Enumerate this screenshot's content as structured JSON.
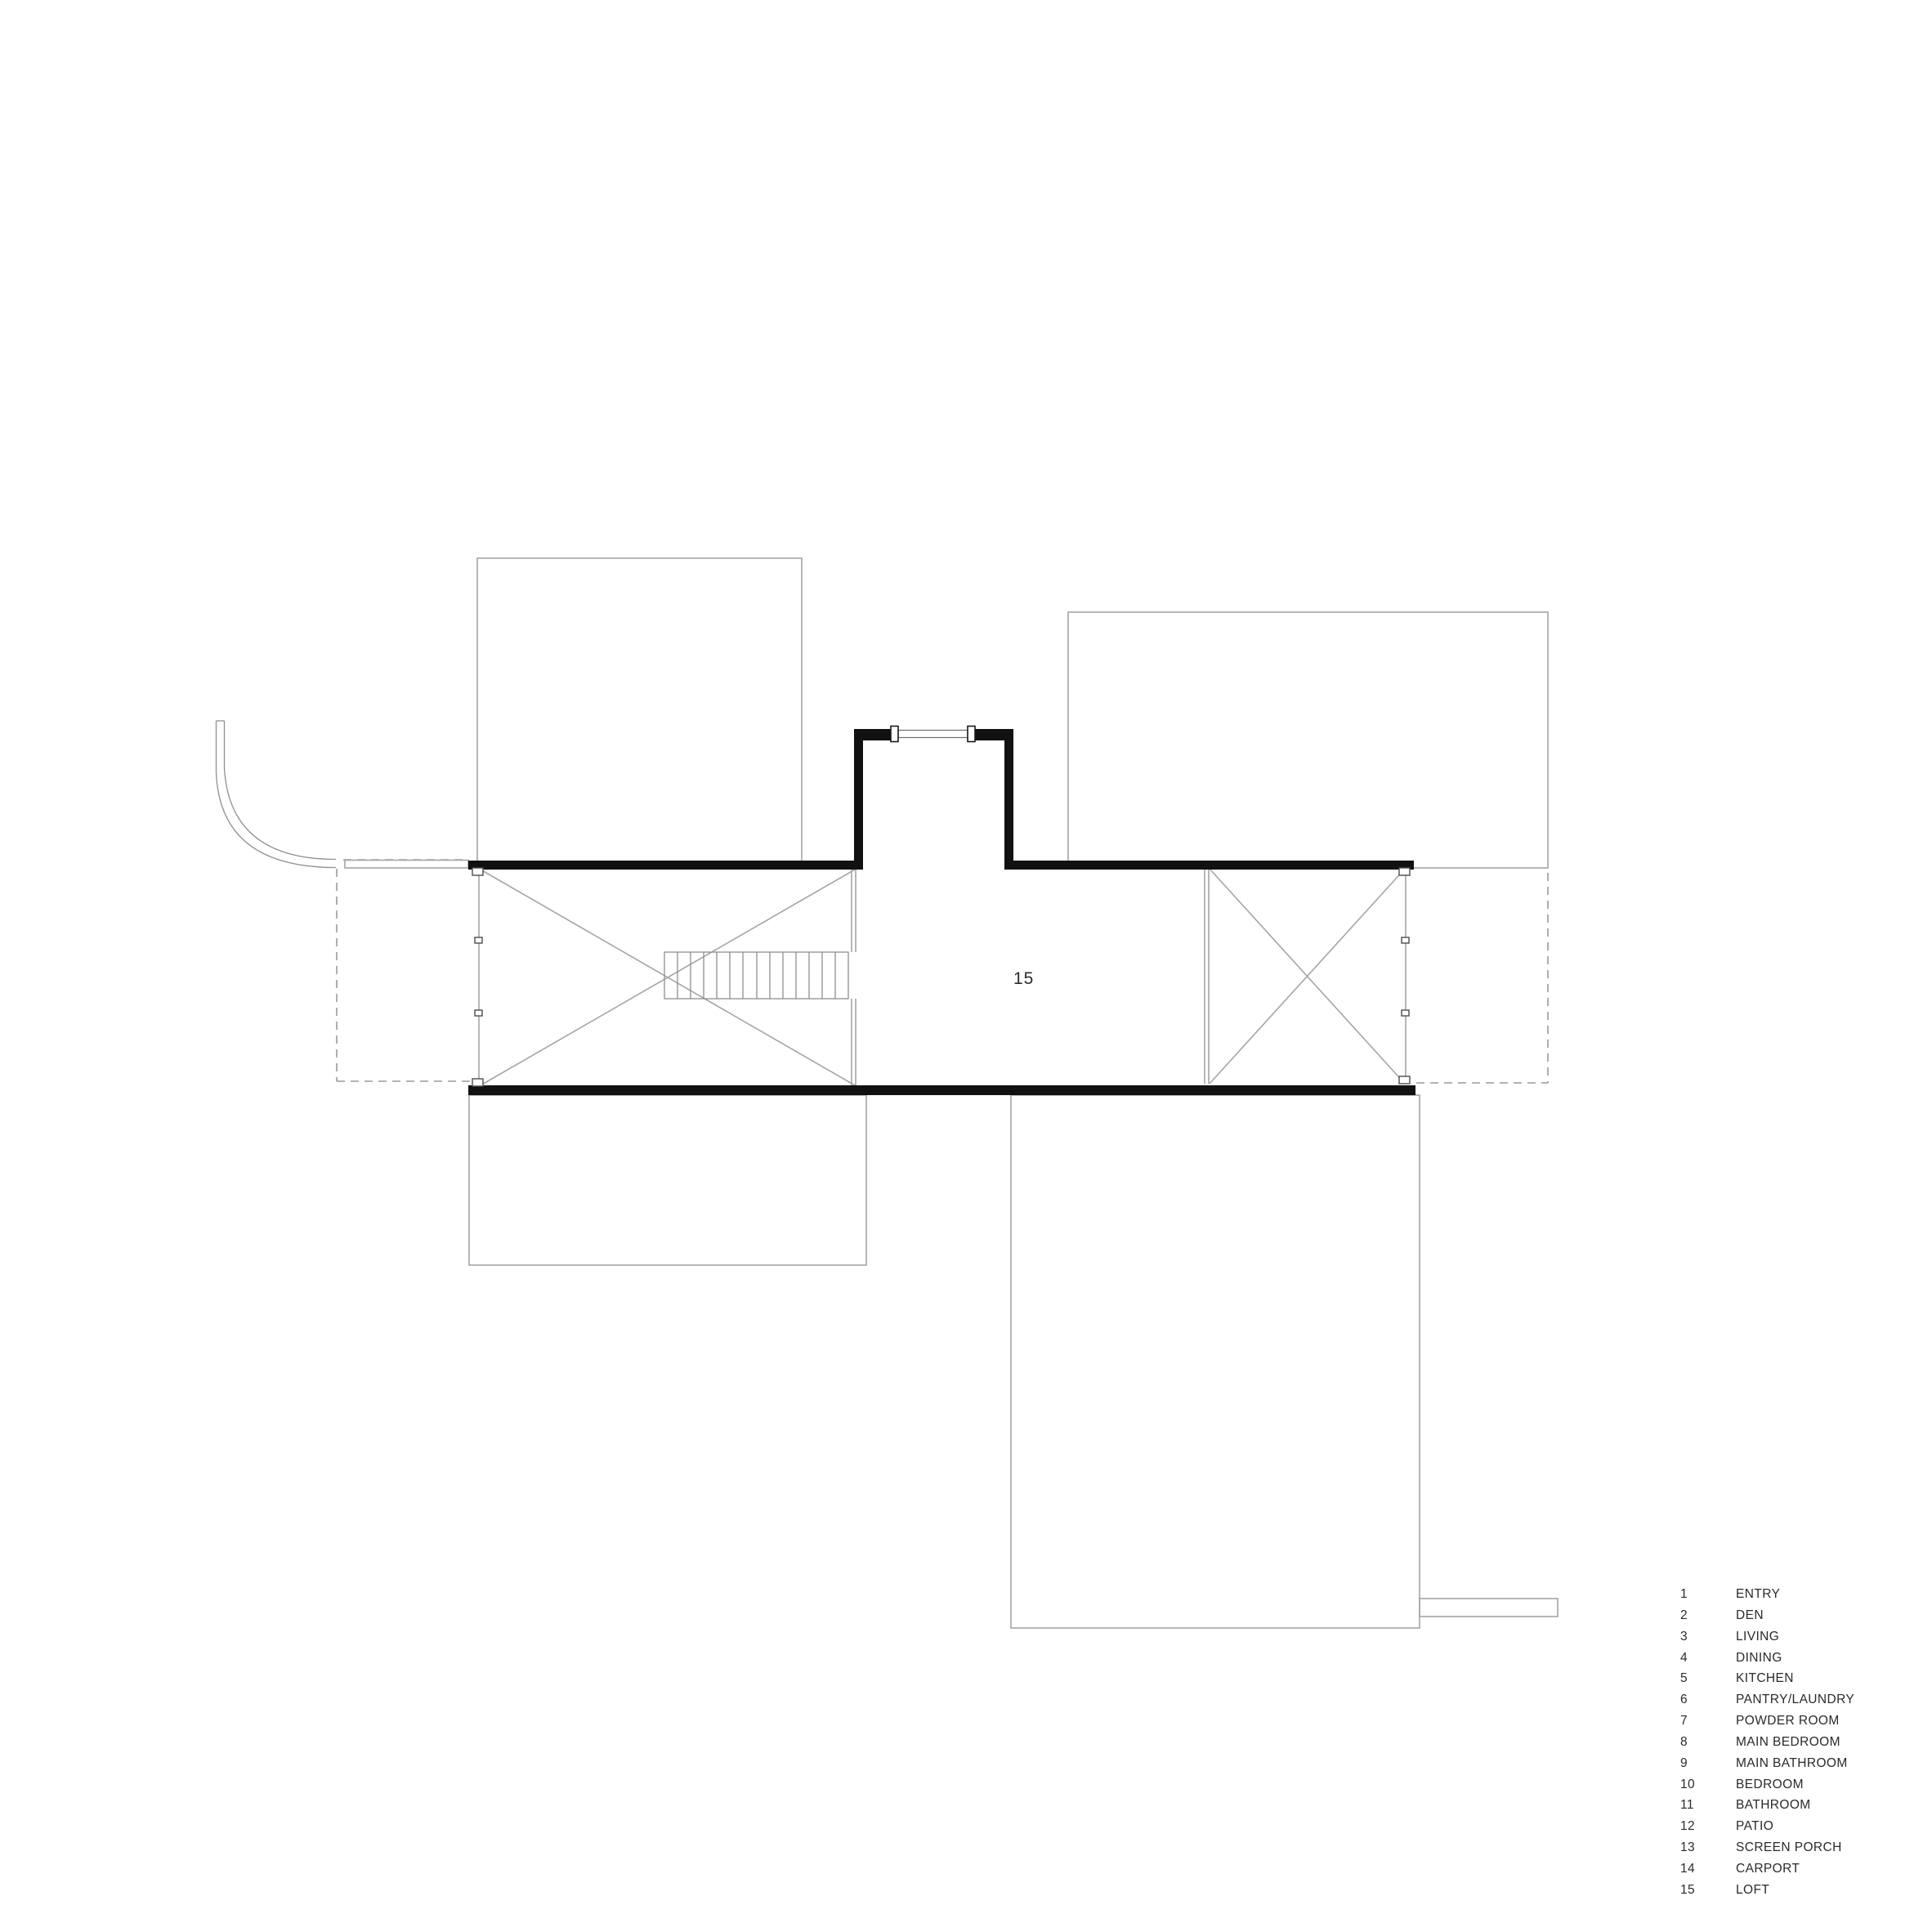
{
  "page": {
    "background": "#ffffff"
  },
  "plan": {
    "room_label": "15",
    "colors": {
      "wall": "#111111",
      "thin": "#a5a5a5",
      "detail": "#8f8f8f",
      "dash": "#9a9a9a",
      "text": "#2a2a2a",
      "bg": "#ffffff"
    }
  },
  "legend": {
    "items": [
      {
        "number": "1",
        "label": "ENTRY"
      },
      {
        "number": "2",
        "label": "DEN"
      },
      {
        "number": "3",
        "label": "LIVING"
      },
      {
        "number": "4",
        "label": "DINING"
      },
      {
        "number": "5",
        "label": "KITCHEN"
      },
      {
        "number": "6",
        "label": "PANTRY/LAUNDRY"
      },
      {
        "number": "7",
        "label": "POWDER ROOM"
      },
      {
        "number": "8",
        "label": "MAIN BEDROOM"
      },
      {
        "number": "9",
        "label": "MAIN BATHROOM"
      },
      {
        "number": "10",
        "label": "BEDROOM"
      },
      {
        "number": "11",
        "label": "BATHROOM"
      },
      {
        "number": "12",
        "label": "PATIO"
      },
      {
        "number": "13",
        "label": "SCREEN PORCH"
      },
      {
        "number": "14",
        "label": "CARPORT"
      },
      {
        "number": "15",
        "label": "LOFT"
      }
    ]
  }
}
